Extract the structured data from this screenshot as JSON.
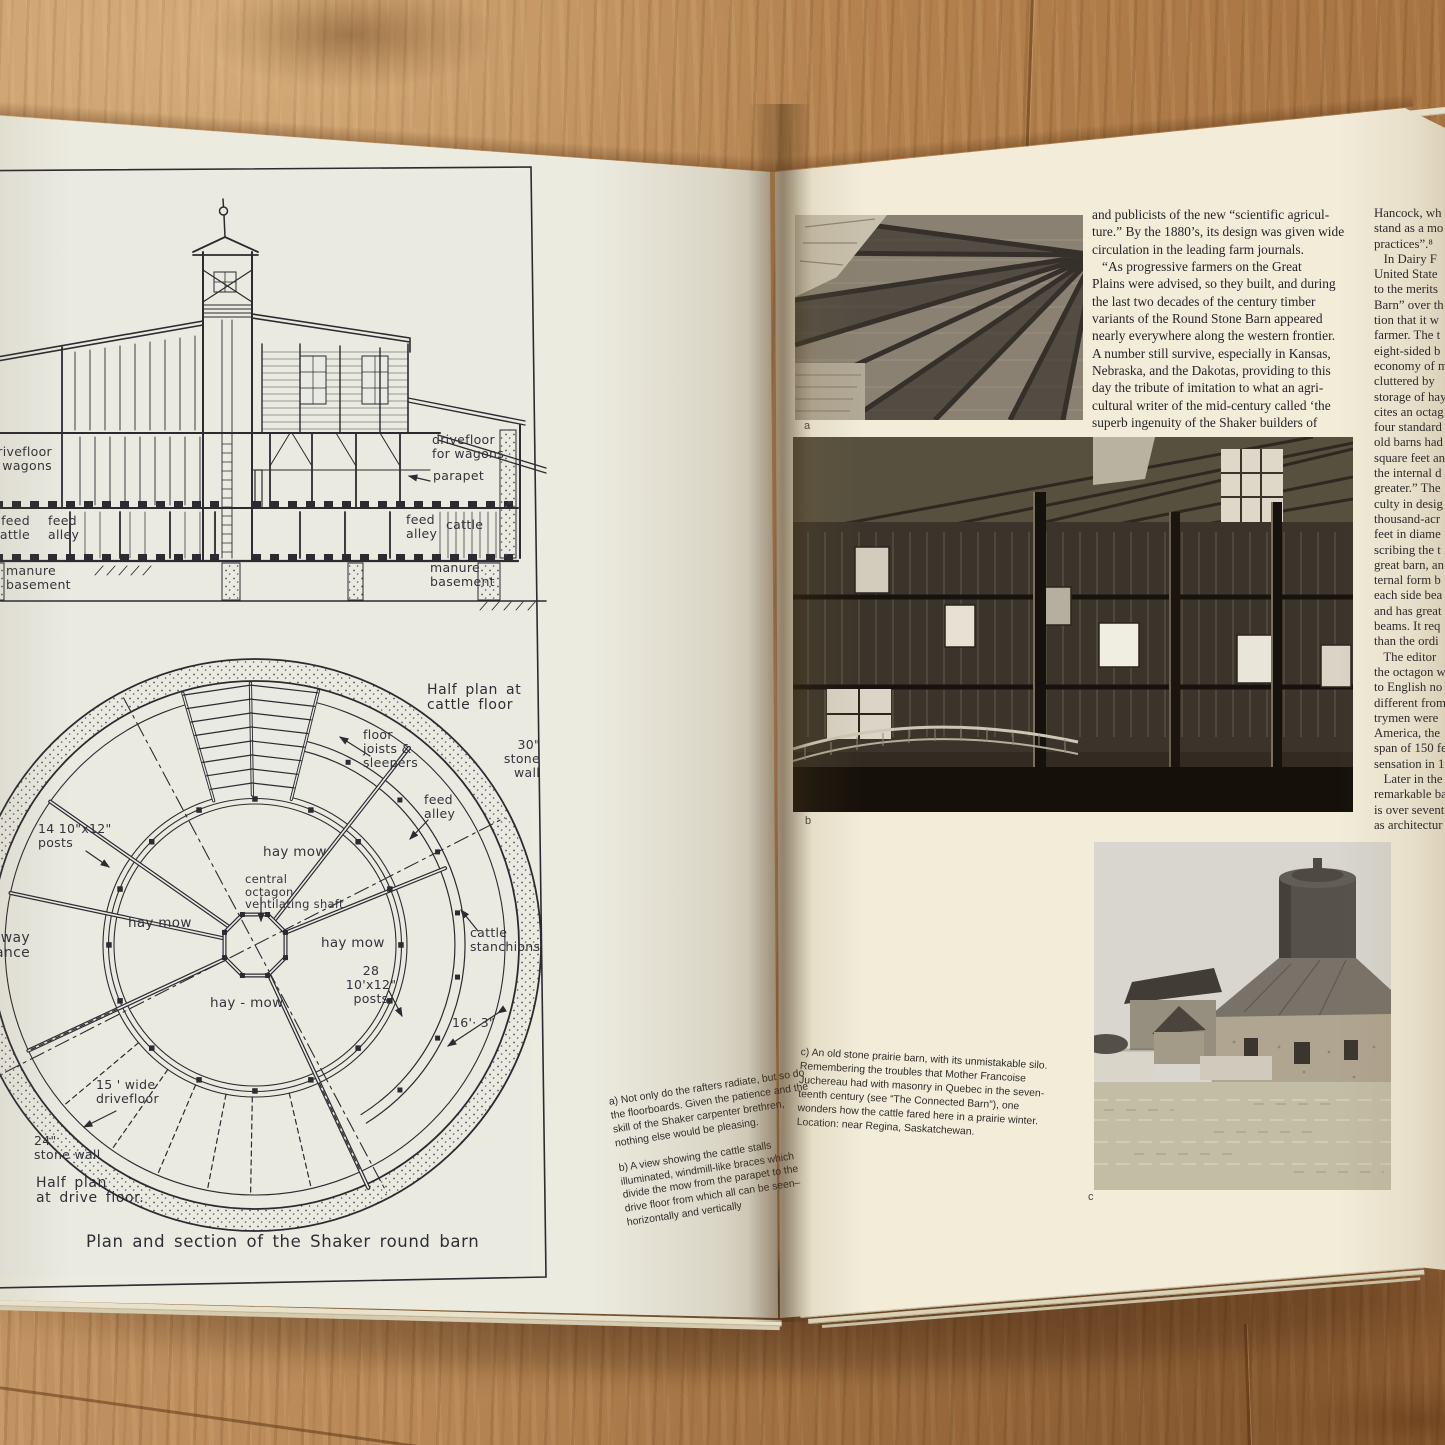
{
  "colors": {
    "wood": "#b2804d",
    "left_page": "#ecebdf",
    "right_page": "#f2ecd9",
    "ink": "#2b2b31",
    "photo_dark": "#2a241d"
  },
  "left_page": {
    "drawing_title": "Plan and section of the Shaker round barn",
    "section_labels": {
      "drivefloor_left": "drivefloor\nfor wagons",
      "feed_cattle_left": "feed\ncattle",
      "feed_alley_left": "feed\nalley",
      "manure_basement_left": "manure\nbasement",
      "drivefloor_right": "drivefloor\nfor wagons",
      "parapet": "parapet",
      "feed_alley_right": "feed\nalley",
      "cattle": "cattle",
      "manure_basement_right": "manure\nbasement"
    },
    "plan_labels": {
      "half_plan_cattle": "Half plan at\ncattle floor",
      "stone_wall_30": "30\" stone\nwall",
      "floor_joists": "floor\njoists &\nsleepers",
      "feed_alley": "feed\nalley",
      "cattle_stanchions": "cattle\nstanchions",
      "hay_mow_top": "hay mow",
      "central_shaft": "central\noctagon\nventilating shaft",
      "hay_mow_left": "hay mow",
      "hay_mow_right": "hay mow",
      "posts_28": "28  10'x12\"\nposts",
      "hay_mow_bottom": "hay - mow",
      "dim_16_3": "16'· 3\"",
      "posts_14": "14  10\"x12\"\nposts",
      "entrance_fragment": "way\nance",
      "drivefloor_15": "15 ' wide\ndrivefloor",
      "stone_wall_24": "24\"\nstone wall",
      "half_plan_drive": "Half plan\nat drive floor."
    },
    "caption_a": "a) Not only do the rafters radiate, but so do the floorboards. Given the patience and the skill of the Shaker carpenter brethren, nothing else would be pleasing.",
    "caption_b": "b) A view showing the cattle stalls illuminated, windmill-like braces which divide the mow from the parapet to the drive floor from which all can be seen–horizontally and vertically"
  },
  "right_page": {
    "column1_lines": [
      "and publicists of the new “scientific agricul-",
      "ture.” By the 1880’s, its design was given wide",
      "circulation in the leading farm journals.",
      "   “As progressive farmers on the Great",
      "Plains were advised, so they built, and during",
      "the last two decades of the century timber",
      "variants of the Round Stone Barn appeared",
      "nearly everywhere along the western frontier.",
      "A number still survive, especially in Kansas,",
      "Nebraska, and the Dakotas, providing to this",
      "day the tribute of imitation to what an agri-",
      "cultural writer of the mid-century called ‘the",
      "superb ingenuity of the Shaker builders of"
    ],
    "column2_lines": [
      "Hancock, wh",
      "stand as a mo",
      "practices”.⁸",
      "   In Dairy F",
      "United State",
      "to the merits",
      "Barn” over th",
      "tion that it w",
      "farmer. The t",
      "eight-sided b",
      "economy of m",
      "cluttered by",
      "storage of hay",
      "cites an octag",
      "four standard",
      "old barns had",
      "square feet an",
      "the internal d",
      "greater.” The",
      "culty in desig",
      "thousand-acr",
      "feet in diame",
      "scribing the t",
      "great barn, an",
      "ternal form b",
      "each side bea",
      "and has great",
      "beams. It req",
      "than the ordi",
      "   The editor",
      "the octagon w",
      "to English no",
      "different from",
      "trymen were",
      "America, the",
      "span of 150 fe",
      "sensation in 1",
      "   Later in the",
      "remarkable ba",
      "is over sevent",
      "as architectur"
    ],
    "photo_letters": {
      "a": "a",
      "b": "b",
      "c": "c"
    },
    "caption_c": "c) An old stone prairie barn, with its unmistakable silo.\nRemembering the troubles that Mother Francoise\nJuchereau had with masonry in Quebec in the seven-\nteenth century (see “The Connected Barn”), one\nwonders how the cattle fared here in a prairie winter.\nLocation: near Regina, Saskatchewan."
  }
}
